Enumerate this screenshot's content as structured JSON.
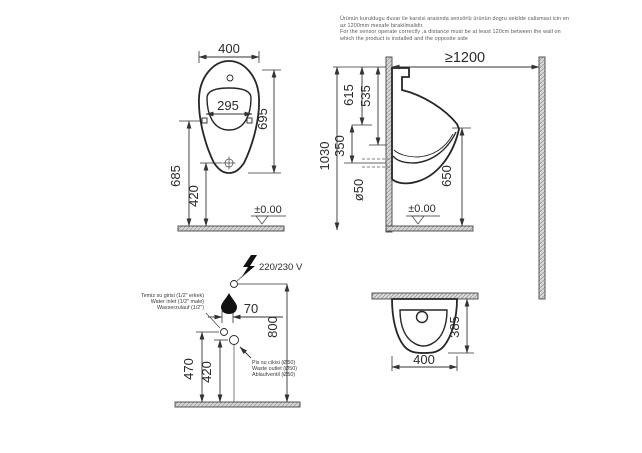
{
  "note": {
    "line1": "Ürünün kuruldugu duvar ile karsisi arasinda sensörlü ürünün dogru sekilde calismasi icin en",
    "line2": "az 1200mm mesafe birakilmalidir.",
    "line3": "For the sensor operate correctly ,a distance must be at least 120cm between the wall on",
    "line4": "which the product is installed and the opposite side"
  },
  "front_view": {
    "overall_width": "400",
    "bowl_width": "295",
    "overall_height": "695",
    "spreader_height": "685",
    "drain_height": "420",
    "floor_level": "±0.00"
  },
  "side_view": {
    "min_wall_distance": "≥1200",
    "overall_height": "1030",
    "inlet_dim": "615",
    "electric_dim": "535",
    "drain_offset": "350",
    "drain_diameter": "ø50",
    "rim_height": "650",
    "floor_level": "±0.00"
  },
  "detail_view": {
    "voltage": "220/230 V",
    "horizontal_offset": "70",
    "electric_height": "800",
    "inlet_height": "470",
    "outlet_height": "420",
    "water_inlet": {
      "tr": "Temiz su girisi (1/2\" erkek)",
      "en": "Water inlet (1/2\" male)",
      "de": "Wasserzulauf (1/2\")"
    },
    "waste_outlet": {
      "tr": "Pis su cikisi (Ø50)",
      "en": "Waste outlet (Ø50)",
      "de": "Ablaufventil (Ø50)"
    }
  },
  "top_view": {
    "depth": "385",
    "width": "400"
  },
  "colors": {
    "line": "#333333",
    "wall_fill": "#d9d9d9"
  }
}
